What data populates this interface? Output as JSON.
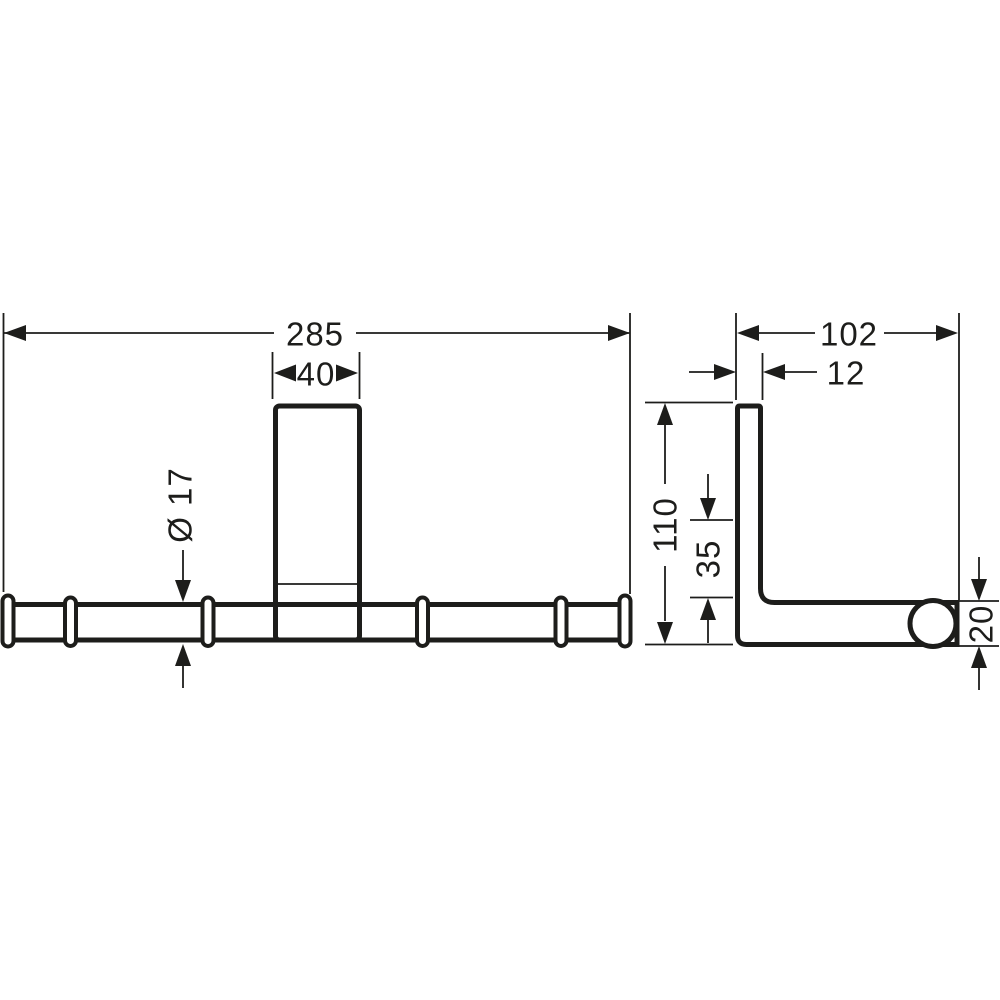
{
  "drawing": {
    "front_view": {
      "overall_width": "285",
      "plate_width": "40",
      "bar_diameter": "Ø 17"
    },
    "side_view": {
      "depth": "102",
      "plate_thickness": "12",
      "height": "110",
      "mount_offset": "35",
      "end_diameter": "20"
    },
    "colors": {
      "line": "#1d1d1b",
      "background": "#ffffff"
    }
  }
}
